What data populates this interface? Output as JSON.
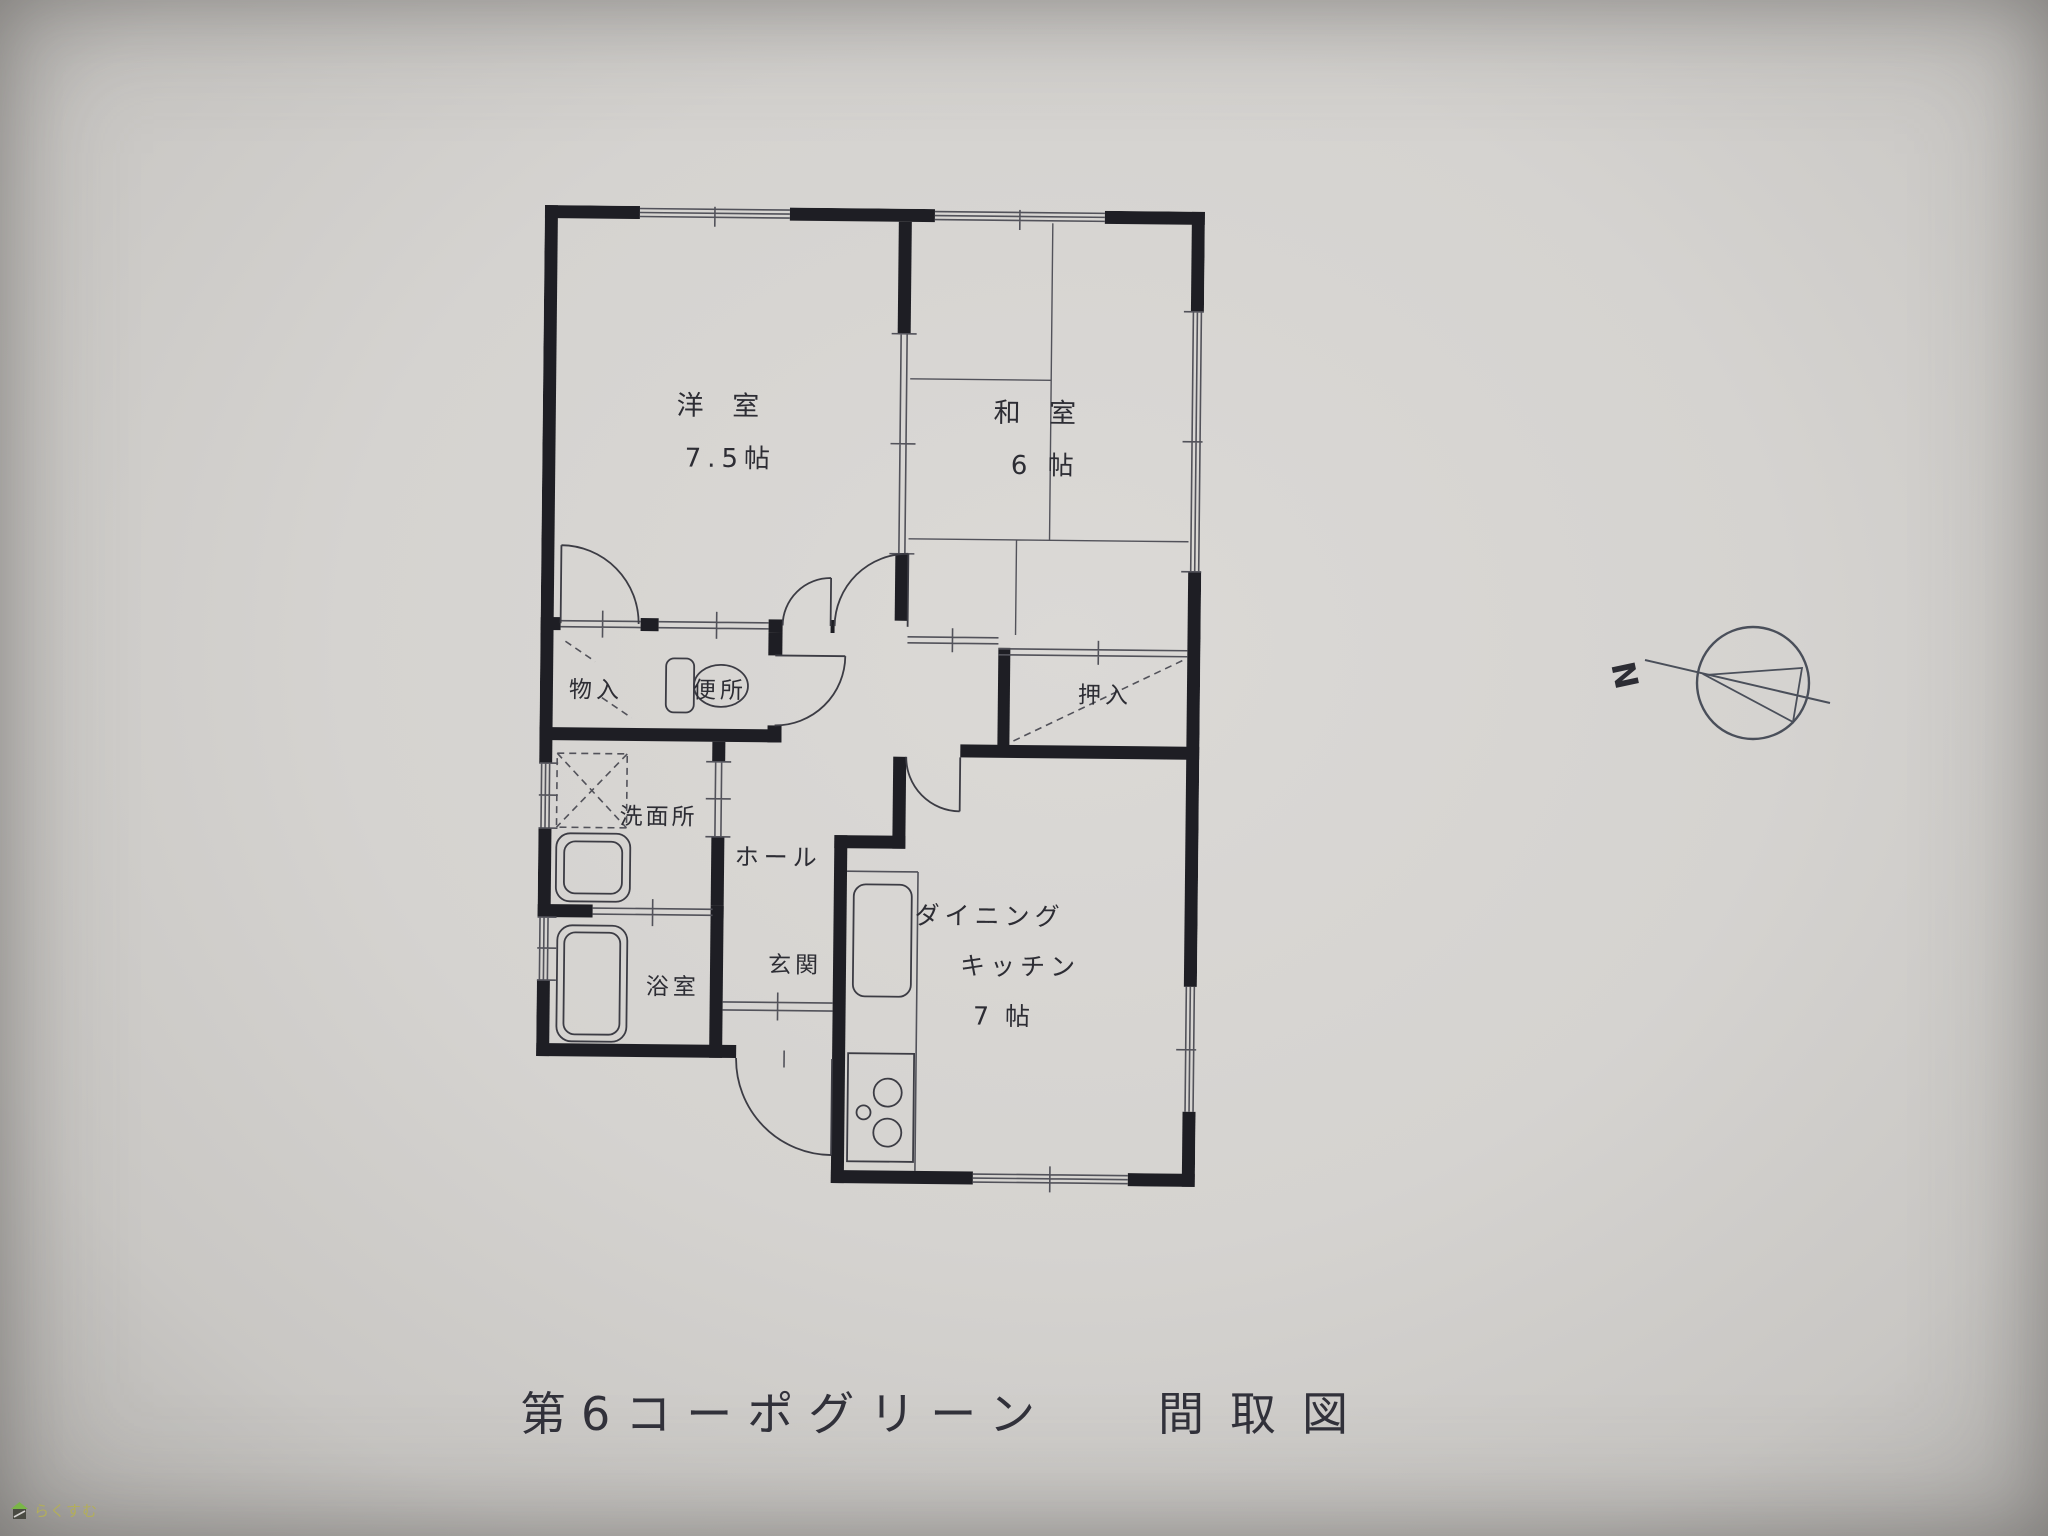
{
  "title": {
    "building": "第6コーポグリーン",
    "doc": "間取図"
  },
  "compass": {
    "north_label": "N"
  },
  "watermark": {
    "brand": "らくすむ",
    "icon": "house-icon"
  },
  "rooms": {
    "western": {
      "name": "洋 室",
      "size": "7.5帖"
    },
    "japanese": {
      "name": "和 室",
      "size": "6 帖"
    },
    "dining_kitchen": {
      "name_line1": "ダイニング",
      "name_line2": "キッチン",
      "size": "7 帖"
    },
    "storage": {
      "name": "物入"
    },
    "toilet": {
      "name": "便所"
    },
    "closet": {
      "name": "押入"
    },
    "washroom": {
      "name": "洗面所"
    },
    "hall": {
      "name": "ホール"
    },
    "bathroom": {
      "name": "浴室"
    },
    "entrance": {
      "name": "玄関"
    }
  },
  "colors": {
    "paper": "#d5d3d0",
    "wall": "#1e1e24",
    "thin_line": "#52525a",
    "text": "#2d2d34",
    "roof_green": "#7ab648",
    "brand_text": "#b3ae5a"
  }
}
